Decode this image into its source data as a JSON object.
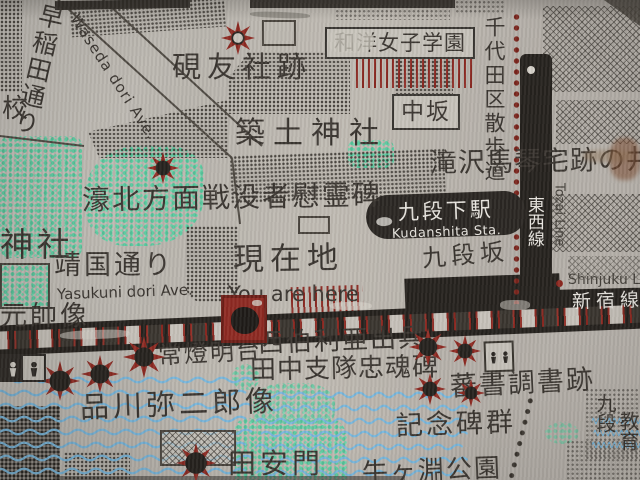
{
  "map": {
    "title": "九段下駅周辺案内図（金属銘板）",
    "streets": {
      "waseda": "早稲田通り",
      "waseda_en": "Waseda dori Ave.",
      "yasukuni": "靖国通り",
      "yasukuni_en": "Yasukuni dori Ave.",
      "nakazaka": "中坂",
      "kudanzaka": "九段坂",
      "chiyoda_walk": "千代田区散歩道"
    },
    "railways": {
      "tozai": "東西線",
      "tozai_en": "Tozai Line",
      "shinjuku": "新宿線",
      "shinjuku_en": "Shinjuku Line"
    },
    "station": {
      "name": "九段下駅",
      "name_en": "Kudanshita Sta."
    },
    "current_location": {
      "label": "現在地",
      "label_en": "You are here"
    },
    "landmarks": {
      "kenyusha": "硯友社跡",
      "joshi_gakuen": "和洋女子学園",
      "tsukudo_shrine": "築土神社",
      "takizawa_well": "滝沢馬琴宅跡の井戸",
      "gohoku_memorial": "濠北方面戦没者慰霊碑",
      "shrine_partial": "神社",
      "school_partial": "校",
      "gensui_statue": "元帥像",
      "joto_lighthouse": "常燈明台",
      "shinagawa_statue": "品川弥二郎像",
      "siberia_line1": "西伯利亜出兵",
      "siberia_line2": "田中支隊忠魂碑",
      "bansho_site": "蕃書調書跡",
      "kinenhi_group": "記念碑群",
      "tayasu_gate": "田安門",
      "ushigafuchi_park": "牛ヶ淵公園",
      "kudan_partial": "九段",
      "kyoiku_partial": "教育"
    },
    "colors": {
      "star_red": "#8e2a22",
      "water_blue": "#7ab6da",
      "park_green": "#5ec9a1",
      "line_black": "#26221e",
      "metal_base": "#bcb7b0"
    }
  }
}
